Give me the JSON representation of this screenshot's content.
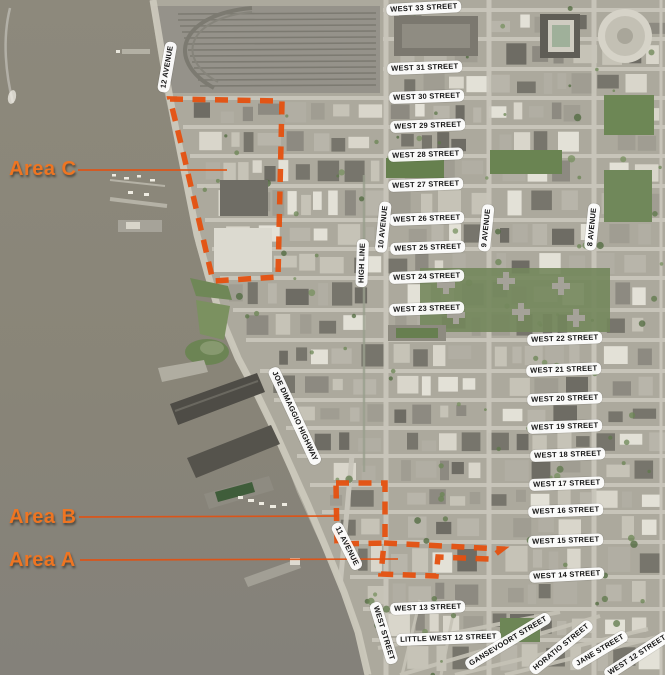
{
  "map": {
    "colors": {
      "outline_orange": "#e5500f",
      "label_orange": "#ee7522",
      "water": "#898578",
      "land": "#aca99d"
    },
    "areas": [
      {
        "id": "area-a",
        "label": "Area A",
        "label_x": 9,
        "label_y": 550,
        "leader": {
          "x1": 80,
          "y1": 560,
          "x2": 398,
          "y2": 559
        },
        "outline_points": "384,543 502,549 489,559 438,557 436,576 381,574"
      },
      {
        "id": "area-b",
        "label": "Area B",
        "label_x": 9,
        "label_y": 507,
        "leader": {
          "x1": 79,
          "y1": 517,
          "x2": 337,
          "y2": 516
        },
        "outline_points": "336,483 385,483 385,543 337,544"
      },
      {
        "id": "area-c",
        "label": "Area C",
        "label_x": 9,
        "label_y": 159,
        "leader": {
          "x1": 78,
          "y1": 170,
          "x2": 227,
          "y2": 170
        },
        "outline_points": "170,99 282,101 278,277 213,281 196,208 183,152"
      }
    ],
    "street_labels": [
      {
        "text": "WEST 33 STREET",
        "x": 386,
        "y": 4,
        "angle": -3
      },
      {
        "text": "WEST 31 STREET",
        "x": 387,
        "y": 63,
        "angle": -2
      },
      {
        "text": "WEST 30 STREET",
        "x": 389,
        "y": 92,
        "angle": -2
      },
      {
        "text": "WEST 29 STREET",
        "x": 390,
        "y": 121,
        "angle": -2
      },
      {
        "text": "WEST 28 STREET",
        "x": 388,
        "y": 150,
        "angle": -2
      },
      {
        "text": "WEST 27 STREET",
        "x": 388,
        "y": 180,
        "angle": -2
      },
      {
        "text": "WEST 26 STREET",
        "x": 389,
        "y": 214,
        "angle": -2
      },
      {
        "text": "WEST 25 STREET",
        "x": 390,
        "y": 243,
        "angle": -2
      },
      {
        "text": "WEST 24 STREET",
        "x": 389,
        "y": 272,
        "angle": -2
      },
      {
        "text": "WEST 23 STREET",
        "x": 389,
        "y": 304,
        "angle": -2
      },
      {
        "text": "WEST 22 STREET",
        "x": 527,
        "y": 334,
        "angle": -2
      },
      {
        "text": "WEST 21 STREET",
        "x": 526,
        "y": 365,
        "angle": -2
      },
      {
        "text": "WEST 20 STREET",
        "x": 527,
        "y": 394,
        "angle": -2
      },
      {
        "text": "WEST 19 STREET",
        "x": 527,
        "y": 422,
        "angle": -2
      },
      {
        "text": "WEST 18 STREET",
        "x": 530,
        "y": 450,
        "angle": -2
      },
      {
        "text": "WEST 17 STREET",
        "x": 529,
        "y": 479,
        "angle": -2
      },
      {
        "text": "WEST 16 STREET",
        "x": 528,
        "y": 506,
        "angle": -2
      },
      {
        "text": "WEST 15 STREET",
        "x": 528,
        "y": 536,
        "angle": -2
      },
      {
        "text": "WEST 14 STREET",
        "x": 529,
        "y": 571,
        "angle": -3
      },
      {
        "text": "WEST 13 STREET",
        "x": 390,
        "y": 603,
        "angle": -2
      },
      {
        "text": "LITTLE WEST 12 STREET",
        "x": 396,
        "y": 634,
        "angle": -2
      }
    ],
    "rotated_labels": [
      {
        "text": "12 AVENUE",
        "x": 167,
        "y": 67,
        "angle": -80
      },
      {
        "text": "10 AVENUE",
        "x": 383,
        "y": 227,
        "angle": -84
      },
      {
        "text": "HIGH LINE",
        "x": 362,
        "y": 263,
        "angle": -88
      },
      {
        "text": "9 AVENUE",
        "x": 486,
        "y": 228,
        "angle": -84
      },
      {
        "text": "8 AVENUE",
        "x": 592,
        "y": 227,
        "angle": -84
      },
      {
        "text": "11 AVENUE",
        "x": 347,
        "y": 546,
        "angle": 63
      },
      {
        "text": "WEST STREET",
        "x": 384,
        "y": 633,
        "angle": 73
      },
      {
        "text": "JOE DIMAGGIO HIGHWAY",
        "x": 295,
        "y": 416,
        "angle": 65
      },
      {
        "text": "GANSEVOORT STREET",
        "x": 508,
        "y": 641,
        "angle": -31
      },
      {
        "text": "HORATIO STREET",
        "x": 561,
        "y": 647,
        "angle": -39
      },
      {
        "text": "JANE STREET",
        "x": 600,
        "y": 650,
        "angle": -31
      },
      {
        "text": "WEST 12 STREET",
        "x": 637,
        "y": 655,
        "angle": -33
      }
    ]
  }
}
